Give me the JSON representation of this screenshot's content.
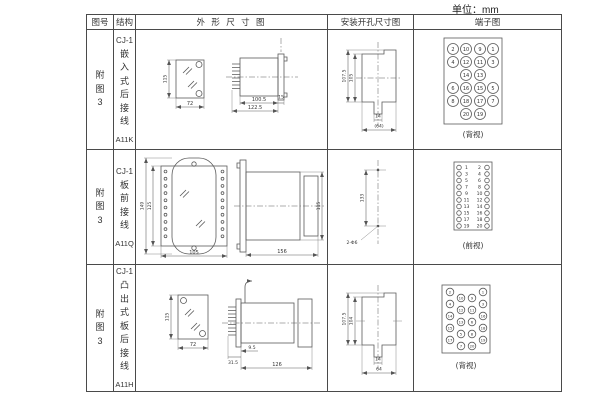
{
  "page": {
    "unit_label": "单位：mm"
  },
  "headers": {
    "fig_no": "图号",
    "structure": "结构",
    "outline": "外 形 尺 寸 图",
    "mounting": "安装开孔尺寸图",
    "terminal": "端子图"
  },
  "rows": [
    {
      "fig_no": "附图3",
      "model": "CJ-1",
      "desc": "嵌入式后接线",
      "code": "A11K",
      "outline": {
        "h": "115",
        "w": "72",
        "body": "100.5",
        "total": "122.5",
        "flange": "15"
      },
      "mounting": {
        "outer_h": "107.5",
        "inner_h": "105",
        "slot_w": "14",
        "outer_w": "(64)"
      },
      "terminal_label": "(背视)",
      "terminals": [
        "2",
        "10",
        "9",
        "1",
        "4",
        "12",
        "11",
        "3",
        "14",
        "13",
        "6",
        "16",
        "15",
        "5",
        "8",
        "18",
        "17",
        "7",
        "20",
        "19"
      ]
    },
    {
      "fig_no": "附图3",
      "model": "CJ-1",
      "desc": "板前接线",
      "code": "A11Q",
      "outline": {
        "outer_h": "149",
        "inner_h": "125",
        "w": "105",
        "len": "156",
        "side_h": "115"
      },
      "mounting": {
        "pitch": "133",
        "holes": "2-Φ6"
      },
      "terminal_label": "(前视)",
      "terminals_left": [
        "1",
        "3",
        "5",
        "7",
        "9",
        "11",
        "13",
        "15",
        "17",
        "19"
      ],
      "terminals_right": [
        "2",
        "4",
        "6",
        "8",
        "10",
        "12",
        "14",
        "16",
        "18",
        "20"
      ]
    },
    {
      "fig_no": "附图3",
      "model": "CJ-1",
      "desc": "凸出式板后接线",
      "code": "A11H",
      "outline": {
        "h": "115",
        "w": "72",
        "pins": "31.5",
        "offset": "9.5",
        "len": "126"
      },
      "mounting": {
        "outer_h": "107.5",
        "inner_h": "104",
        "slot_w": "14",
        "outer_w": "64"
      },
      "terminal_label": "(背视)",
      "terminals": [
        "2",
        "10",
        "9",
        "1",
        "4",
        "12",
        "11",
        "3",
        "14",
        "13",
        "6",
        "16",
        "15",
        "5",
        "8",
        "18",
        "17",
        "7",
        "20",
        "19"
      ]
    }
  ]
}
